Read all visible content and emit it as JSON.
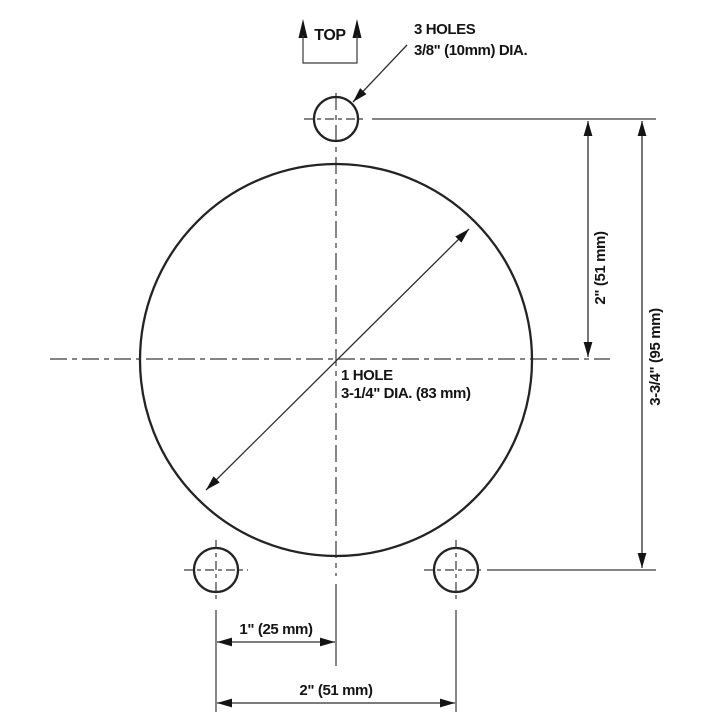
{
  "diagram": {
    "type": "engineering-drawing",
    "description": "Drilling template: one large center hole and three small mounting holes with dimensions",
    "orientation_label": "TOP",
    "annotations": {
      "small_holes": {
        "line1": "3 HOLES",
        "line2": "3/8\" (10mm) DIA."
      },
      "large_hole": {
        "line1": "1 HOLE",
        "line2": "3-1/4\" DIA. (83 mm)"
      }
    },
    "dimensions": {
      "top_hole_to_center": "2\" (51 mm)",
      "top_hole_to_bottom_holes": "3-3/4\" (95 mm)",
      "bottom_hole_to_centerline": "1\" (25 mm)",
      "bottom_hole_spacing": "2\" (51 mm)"
    },
    "colors": {
      "background": "#ffffff",
      "object_line": "#242424",
      "thin_line": "#3a3a3a",
      "text": "#141414"
    }
  }
}
